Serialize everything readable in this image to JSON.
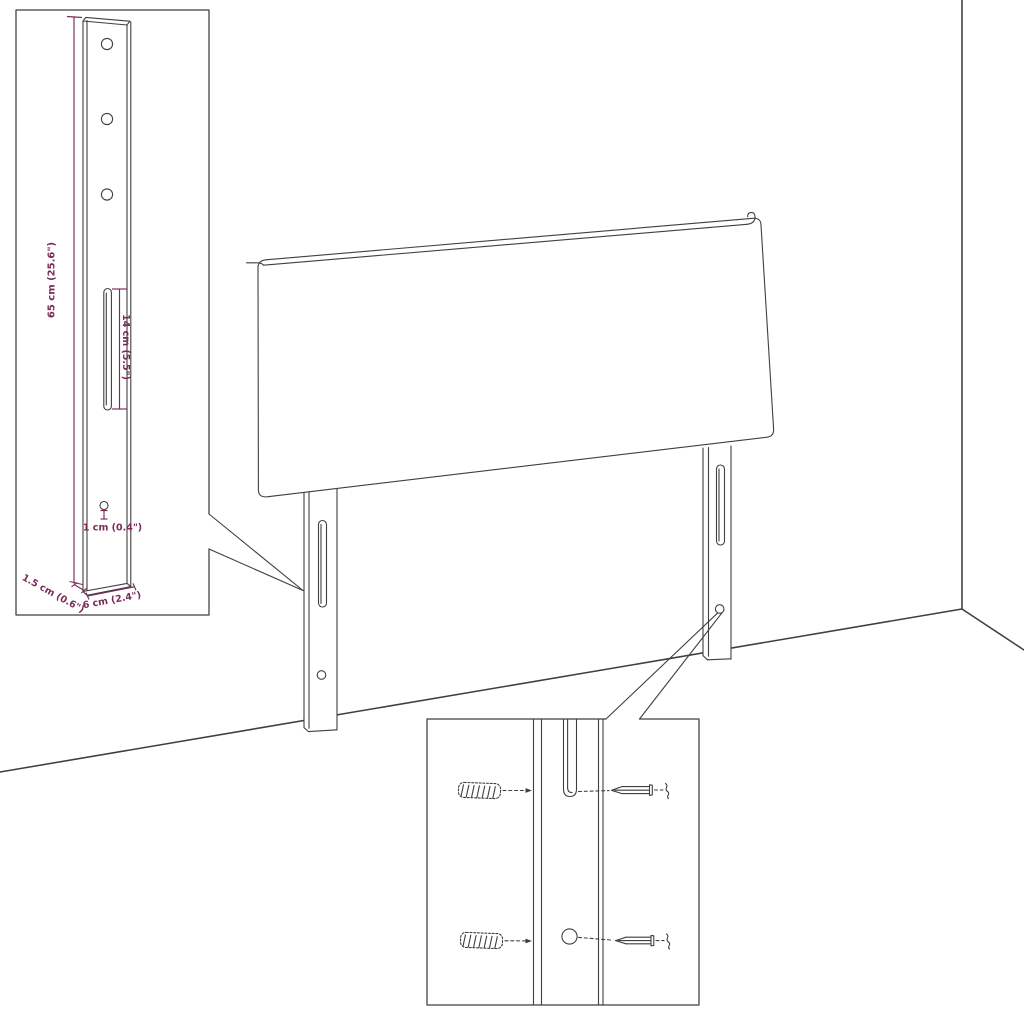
{
  "diagram": {
    "colors": {
      "line": "#3f3f3f",
      "dimension": "#7b2a5a",
      "background": "#ffffff"
    },
    "labels": {
      "leg_height": "65 cm (25.6\")",
      "slot_length": "14 cm (5.5\")",
      "hole_size": "1 cm (0.4\")",
      "leg_depth": "1.5 cm (0.6\")",
      "leg_width": "6 cm (2.4\")"
    }
  }
}
